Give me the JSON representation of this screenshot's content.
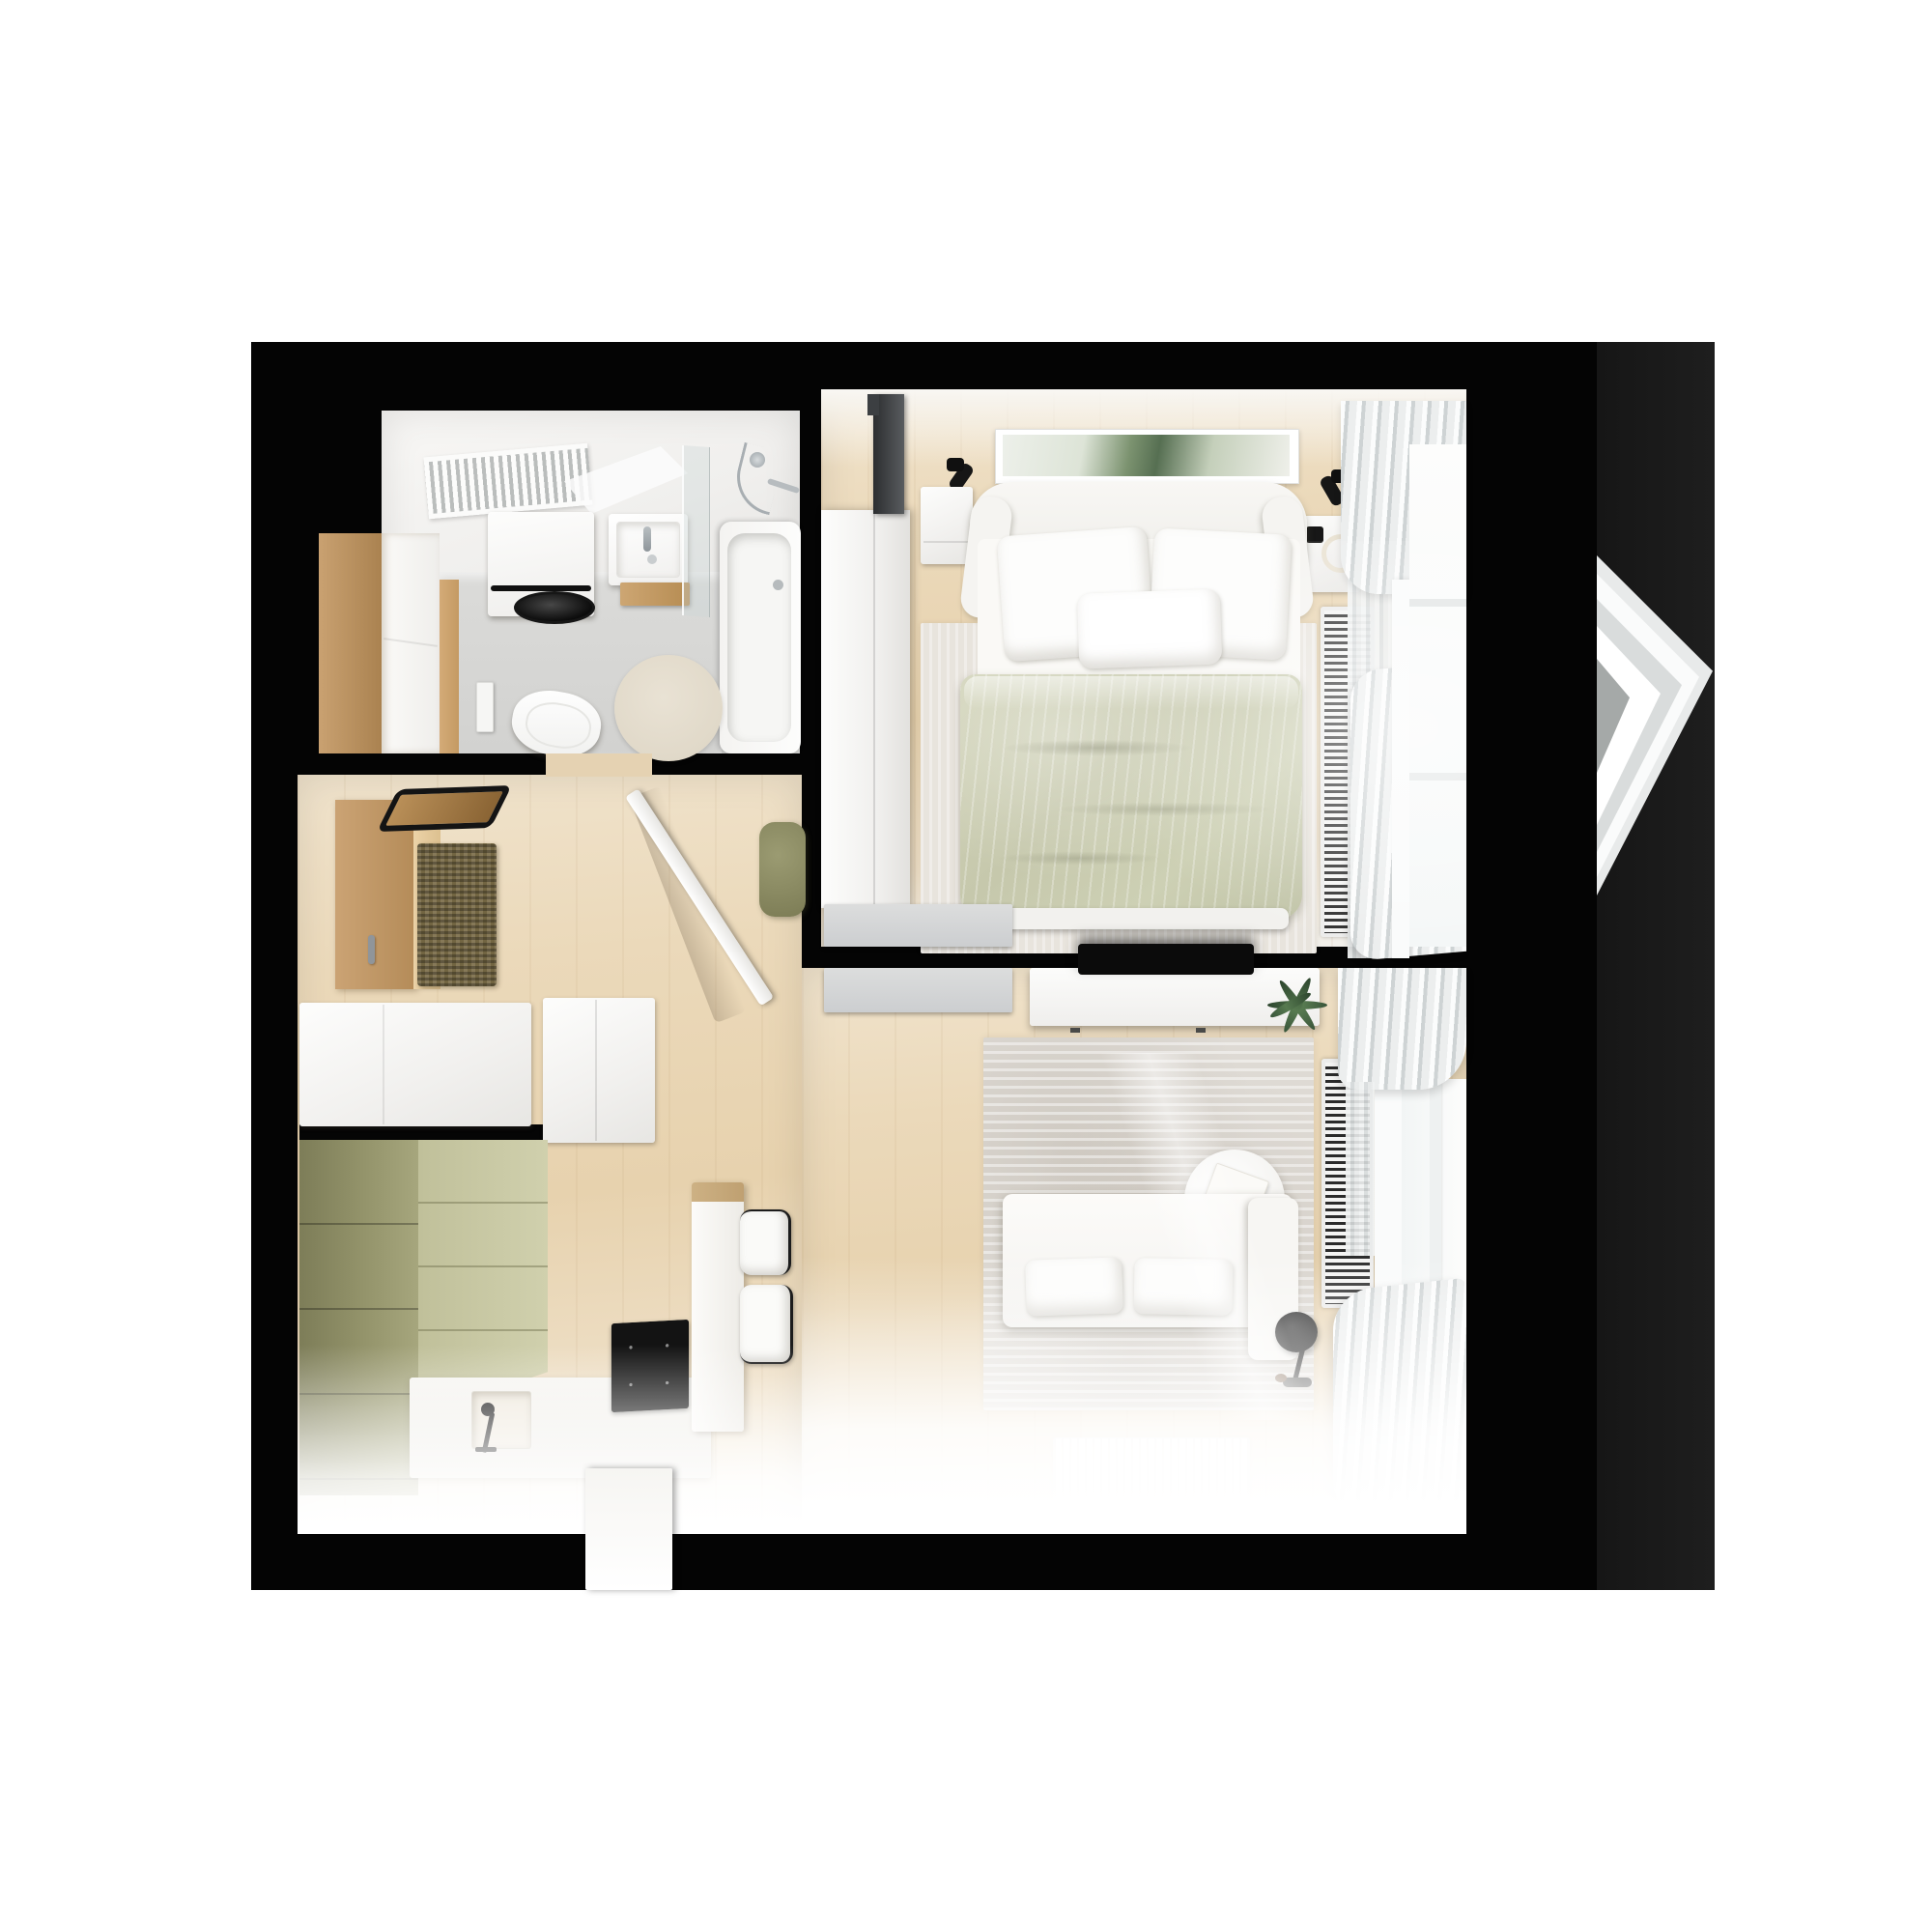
{
  "meta": {
    "title": "Apartment floor plan – top-down 3D render",
    "view": "top-down"
  },
  "palette": {
    "background": "#ffffff",
    "walls": "#040404",
    "annex_strip": "#1a1a1a",
    "wood_floor": "#e9d6b4",
    "bathroom_tile": "#d6d6d4",
    "olive_cabinet": "#8d8d64",
    "olive_front": "#c7c7a2",
    "sage_duvet": "#caccb1",
    "accent_wood": "#c09a6a",
    "rug_gray": "#dedad4",
    "furniture_white": "#fbfbfa"
  },
  "rooms": {
    "bathroom": {
      "label": "Bathroom",
      "items": [
        "towel radiator",
        "tilted mirror",
        "washing machine",
        "washbasin with vanity",
        "glass shower screen",
        "bathtub with shower set",
        "wall-hung toilet",
        "flush plate",
        "round beige rug",
        "wooden tall cabinet"
      ]
    },
    "hallway": {
      "label": "Entry hall",
      "items": [
        "black framed mirror",
        "wood wall panel",
        "woven bench seat",
        "coat hook",
        "white sideboard",
        "white cabinet",
        "open door leaf",
        "olive pouf"
      ]
    },
    "kitchen": {
      "label": "Kitchen",
      "items": [
        "olive tall cabinets",
        "olive cabinet fronts",
        "white countertop",
        "sink with black faucet",
        "black induction cooktop",
        "white peninsula column",
        "two bar stools with black frames",
        "white base cabinet"
      ]
    },
    "bedroom": {
      "label": "Bedroom",
      "items": [
        "double bed with sage green duvet",
        "white winged headboard",
        "two white pillows",
        "small white pillow",
        "left nightstand",
        "right nightstand",
        "black wall sconces",
        "green abstract artwork",
        "sliding-door wardrobe",
        "wall TV panel",
        "bedside rug",
        "floor radiator grille",
        "curtains",
        "window"
      ]
    },
    "living_room": {
      "label": "Living room",
      "items": [
        "white TV console",
        "flat TV",
        "green plant",
        "mottled gray rug",
        "round coffee table with book",
        "white sofa with chaise",
        "two seat cushions",
        "black floor lamp",
        "white floor mat",
        "floor radiator grille",
        "curtains",
        "window"
      ]
    },
    "bay": {
      "label": "Triangular bay window"
    }
  }
}
